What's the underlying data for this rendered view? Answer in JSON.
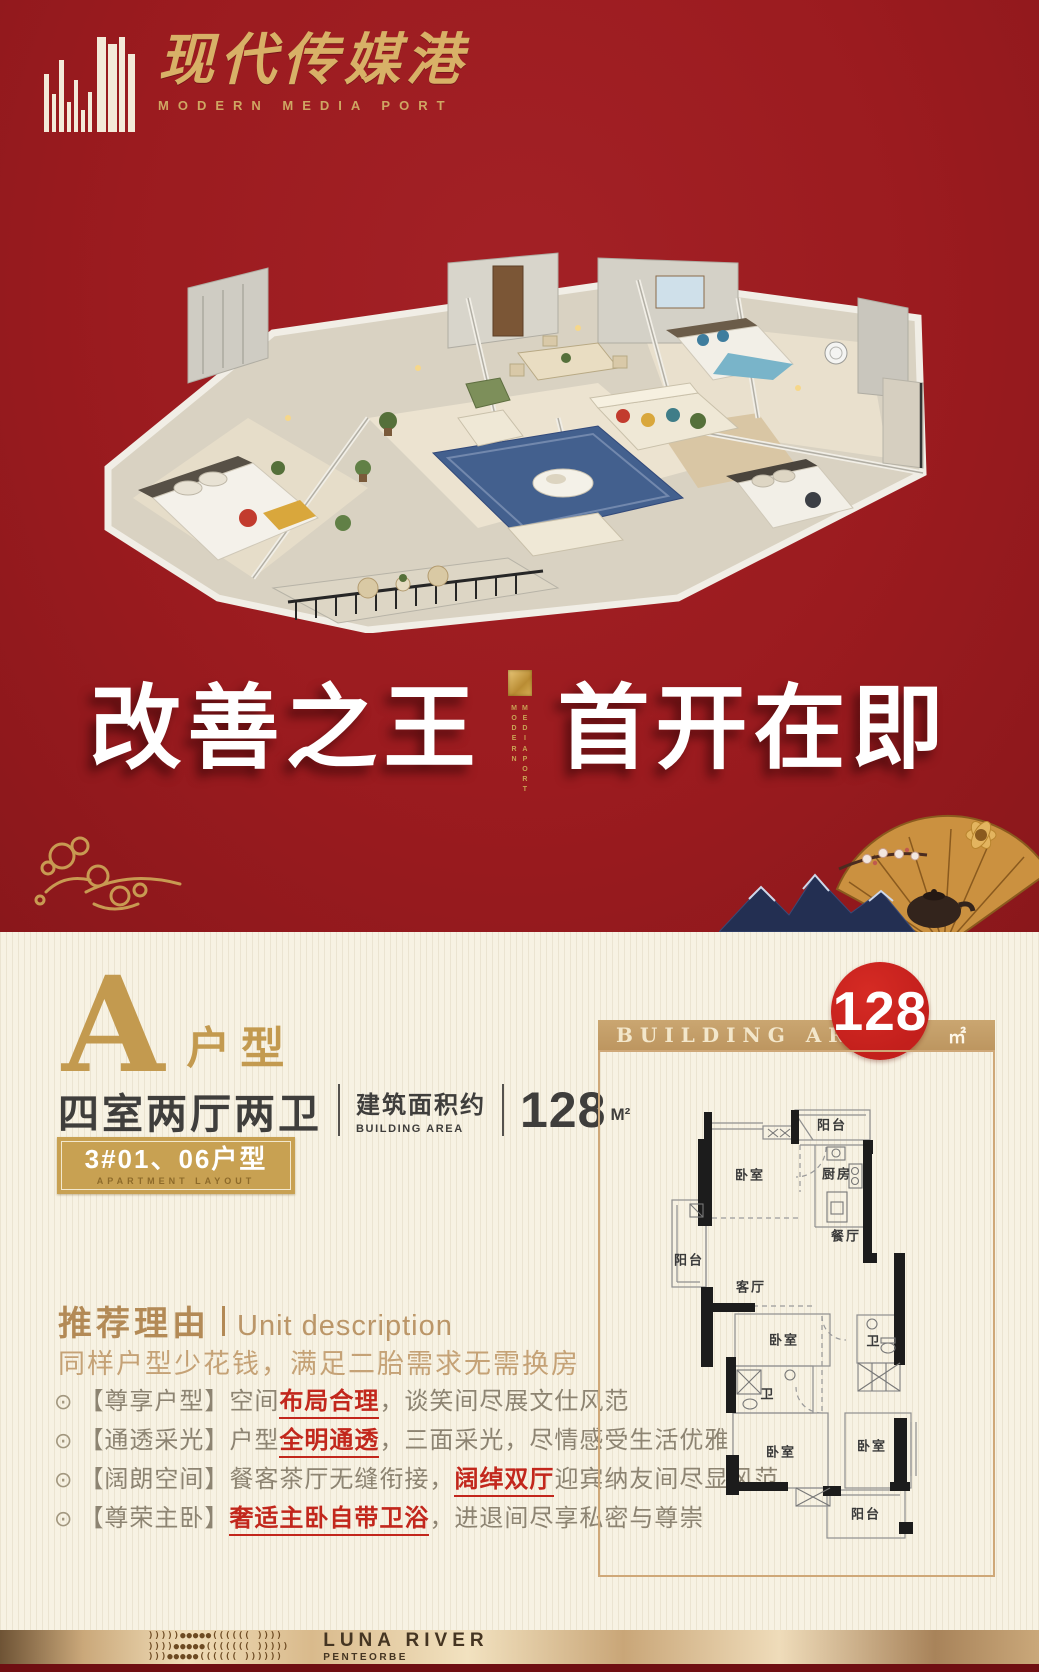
{
  "brand": {
    "name_cn": "现代传媒港",
    "name_en": "MODERN MEDIA PORT"
  },
  "hero": {
    "headline_left": "改善之王",
    "headline_right": "首开在即",
    "divider_word1": "MODERN",
    "divider_word2": "MEDIA PORT"
  },
  "unit": {
    "letter": "A",
    "type_label": "户型",
    "rooms": "四室两厅两卫",
    "area_label_cn": "建筑面积约",
    "area_label_en": "BUILDING AREA",
    "area_value": "128",
    "area_unit": "M²",
    "badge_line1": "3#01、06户型",
    "badge_line2": "APARTMENT LAYOUT"
  },
  "description": {
    "title_cn": "推荐理由",
    "title_en": "Unit description",
    "subtitle": "同样户型少花钱，满足二胎需求无需换房",
    "bullets": [
      {
        "icon": "⊙",
        "tag": "【尊享户型】",
        "pre": "空间",
        "highlight": "布局合理",
        "post": "，谈笑间尽展文仕风范"
      },
      {
        "icon": "⊙",
        "tag": "【通透采光】",
        "pre": "户型",
        "highlight": "全明通透",
        "post": "，三面采光，尽情感受生活优雅"
      },
      {
        "icon": "⊙",
        "tag": "【阔朗空间】",
        "pre": "餐客茶厅无缝衔接，",
        "highlight": "阔绰双厅",
        "post": "迎宾纳友间尽显风范"
      },
      {
        "icon": "⊙",
        "tag": "【尊荣主卧】",
        "pre": "",
        "highlight": "奢适主卧自带卫浴",
        "post": "，进退间尽享私密与尊崇"
      }
    ]
  },
  "floorplan": {
    "header": "BUILDING AREA",
    "area_value": "128",
    "area_unit": "㎡",
    "rooms": [
      {
        "label": "阳台",
        "x": 232,
        "y": 72
      },
      {
        "label": "卧室",
        "x": 150,
        "y": 122
      },
      {
        "label": "厨房",
        "x": 237,
        "y": 121
      },
      {
        "label": "餐厅",
        "x": 246,
        "y": 183
      },
      {
        "label": "阳台",
        "x": 89,
        "y": 207
      },
      {
        "label": "客厅",
        "x": 151,
        "y": 234
      },
      {
        "label": "卧室",
        "x": 184,
        "y": 287
      },
      {
        "label": "卫",
        "x": 274,
        "y": 288
      },
      {
        "label": "卫",
        "x": 168,
        "y": 341
      },
      {
        "label": "卧室",
        "x": 181,
        "y": 399
      },
      {
        "label": "卧室",
        "x": 272,
        "y": 393
      },
      {
        "label": "阳台",
        "x": 266,
        "y": 461
      }
    ]
  },
  "footer": {
    "title": "LUNA RIVER",
    "subtitle": "PENTEORBE",
    "pattern_rows": [
      ")))))●●●●●((((((  ))))",
      "))))●●●●●(((((((  )))))",
      ")))●●●●●((((((   ))))))"
    ]
  },
  "colors": {
    "background_red": "#9B1B1F",
    "gold": "#C8A152",
    "circle_red": "#C31F1C",
    "accent_red": "#C2271C",
    "cream": "#F7F2E3",
    "dark_text": "#3F3E3C",
    "tan_text": "#B38A56",
    "body_text": "#8D8472"
  }
}
